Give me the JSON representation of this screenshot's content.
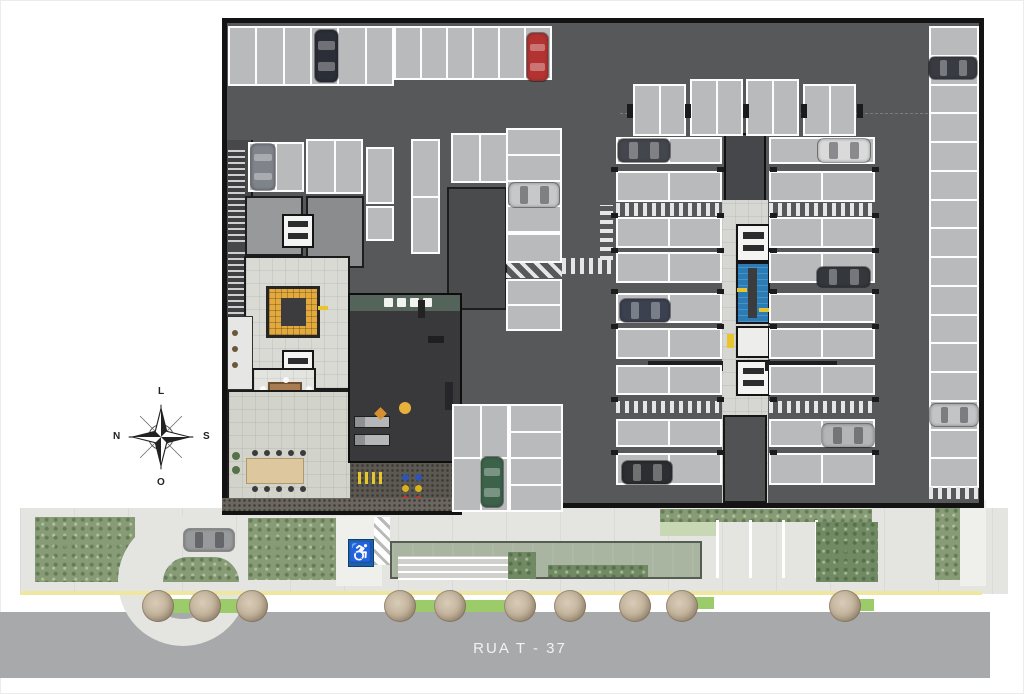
{
  "street": {
    "name": "RUA T - 37"
  },
  "compass": {
    "top": "L",
    "right": "S",
    "bottom": "O",
    "left": "N"
  },
  "symbols": {
    "accessibility": "♿"
  },
  "colors": {
    "garage_floor": "#57585a",
    "garage_border": "#131313",
    "parking_space": "#b9babc",
    "parking_outline": "#fdfdfd",
    "gym_floor": "#39393b",
    "lobby_floor": "#d9dad4",
    "feature_stair_yellow": "#e3a93c",
    "stairwell_blue": "#2b7cb4",
    "accessibility_blue": "#1e5fa9",
    "sidewalk": "#e4e5e1",
    "road": "#a8a9ab",
    "curb_line_yellow": "#efe6a0",
    "hedge_green": "#879c76",
    "grass_green": "#9ccb6a",
    "canopy_green": "#a9b4a1",
    "tree_canopy": "#bcab93",
    "wood_table": "#a87c52",
    "terrace_table": "#dcc79e"
  },
  "parking_groups": [
    {
      "x": 228,
      "y": 26,
      "w": 166,
      "h": 60,
      "cols": 6,
      "rows": 1
    },
    {
      "x": 394,
      "y": 26,
      "w": 158,
      "h": 54,
      "cols": 6,
      "rows": 1
    },
    {
      "x": 248,
      "y": 142,
      "w": 56,
      "h": 50,
      "cols": 2,
      "rows": 1
    },
    {
      "x": 306,
      "y": 139,
      "w": 57,
      "h": 55,
      "cols": 2,
      "rows": 1
    },
    {
      "x": 366,
      "y": 147,
      "w": 28,
      "h": 57,
      "cols": 1,
      "rows": 1
    },
    {
      "x": 411,
      "y": 139,
      "w": 29,
      "h": 63,
      "cols": 1,
      "rows": 1
    },
    {
      "x": 366,
      "y": 206,
      "w": 28,
      "h": 35,
      "cols": 1,
      "rows": 1
    },
    {
      "x": 411,
      "y": 196,
      "w": 29,
      "h": 58,
      "cols": 1,
      "rows": 1
    },
    {
      "x": 451,
      "y": 133,
      "w": 57,
      "h": 50,
      "cols": 2,
      "rows": 1
    },
    {
      "x": 452,
      "y": 404,
      "w": 57,
      "h": 108,
      "cols": 2,
      "rows": 2
    },
    {
      "x": 509,
      "y": 404,
      "w": 54,
      "h": 108,
      "cols": 1,
      "rows": 4
    },
    {
      "x": 506,
      "y": 128,
      "w": 56,
      "h": 105,
      "cols": 1,
      "rows": 4
    },
    {
      "x": 506,
      "y": 279,
      "w": 56,
      "h": 52,
      "cols": 1,
      "rows": 2
    },
    {
      "x": 633,
      "y": 84,
      "w": 53,
      "h": 52,
      "cols": 2,
      "rows": 1
    },
    {
      "x": 690,
      "y": 79,
      "w": 53,
      "h": 57,
      "cols": 2,
      "rows": 1
    },
    {
      "x": 746,
      "y": 79,
      "w": 53,
      "h": 57,
      "cols": 2,
      "rows": 1
    },
    {
      "x": 803,
      "y": 84,
      "w": 53,
      "h": 52,
      "cols": 2,
      "rows": 1
    },
    {
      "x": 616,
      "y": 137,
      "w": 106,
      "h": 27,
      "cols": 2,
      "rows": 1
    },
    {
      "x": 616,
      "y": 171,
      "w": 106,
      "h": 31,
      "cols": 2,
      "rows": 1
    },
    {
      "x": 616,
      "y": 217,
      "w": 106,
      "h": 31,
      "cols": 2,
      "rows": 1
    },
    {
      "x": 616,
      "y": 252,
      "w": 106,
      "h": 31,
      "cols": 2,
      "rows": 1
    },
    {
      "x": 616,
      "y": 293,
      "w": 106,
      "h": 30,
      "cols": 2,
      "rows": 1
    },
    {
      "x": 616,
      "y": 328,
      "w": 106,
      "h": 31,
      "cols": 2,
      "rows": 1
    },
    {
      "x": 616,
      "y": 365,
      "w": 106,
      "h": 30,
      "cols": 2,
      "rows": 1
    },
    {
      "x": 616,
      "y": 419,
      "w": 106,
      "h": 28,
      "cols": 2,
      "rows": 1
    },
    {
      "x": 616,
      "y": 453,
      "w": 106,
      "h": 32,
      "cols": 2,
      "rows": 1
    },
    {
      "x": 769,
      "y": 137,
      "w": 106,
      "h": 27,
      "cols": 2,
      "rows": 1
    },
    {
      "x": 769,
      "y": 171,
      "w": 106,
      "h": 31,
      "cols": 2,
      "rows": 1
    },
    {
      "x": 769,
      "y": 217,
      "w": 106,
      "h": 31,
      "cols": 2,
      "rows": 1
    },
    {
      "x": 769,
      "y": 252,
      "w": 106,
      "h": 31,
      "cols": 2,
      "rows": 1
    },
    {
      "x": 769,
      "y": 293,
      "w": 106,
      "h": 30,
      "cols": 2,
      "rows": 1
    },
    {
      "x": 769,
      "y": 328,
      "w": 106,
      "h": 31,
      "cols": 2,
      "rows": 1
    },
    {
      "x": 769,
      "y": 365,
      "w": 106,
      "h": 30,
      "cols": 2,
      "rows": 1
    },
    {
      "x": 769,
      "y": 419,
      "w": 106,
      "h": 28,
      "cols": 2,
      "rows": 1
    },
    {
      "x": 769,
      "y": 453,
      "w": 106,
      "h": 32,
      "cols": 2,
      "rows": 1
    },
    {
      "x": 929,
      "y": 26,
      "w": 50,
      "h": 462,
      "cols": 1,
      "rows": 16
    }
  ],
  "accessible_space": {
    "x": 506,
    "y": 233,
    "w": 56,
    "h": 30
  },
  "zebras": [
    {
      "x": 562,
      "y": 258,
      "w": 50,
      "h": 16,
      "t": "v"
    },
    {
      "x": 600,
      "y": 205,
      "w": 13,
      "h": 55,
      "t": "h"
    },
    {
      "x": 616,
      "y": 203,
      "w": 106,
      "h": 13,
      "t": "v"
    },
    {
      "x": 769,
      "y": 203,
      "w": 106,
      "h": 13,
      "t": "v"
    },
    {
      "x": 616,
      "y": 401,
      "w": 106,
      "h": 12,
      "t": "v"
    },
    {
      "x": 769,
      "y": 401,
      "w": 106,
      "h": 12,
      "t": "v"
    },
    {
      "x": 929,
      "y": 487,
      "w": 50,
      "h": 12,
      "t": "v"
    },
    {
      "x": 506,
      "y": 263,
      "w": 56,
      "h": 15,
      "t": "d"
    },
    {
      "x": 374,
      "y": 517,
      "w": 16,
      "h": 48,
      "t": "ds"
    }
  ],
  "wall_ticks": {
    "xs": [
      611,
      717,
      770,
      872
    ],
    "ys": [
      167,
      213,
      248,
      289,
      324,
      397,
      450
    ],
    "w": 7,
    "h": 5
  },
  "pair_ticks": {
    "y": 104,
    "xs": [
      627,
      685,
      743,
      801,
      857
    ],
    "w": 6,
    "h": 14
  },
  "cars": [
    {
      "x": 315,
      "y": 30,
      "w": 23,
      "h": 52,
      "dir": "v",
      "c": "#2b2e36"
    },
    {
      "x": 527,
      "y": 33,
      "w": 21,
      "h": 48,
      "dir": "v",
      "c": "#b23331"
    },
    {
      "x": 251,
      "y": 144,
      "w": 24,
      "h": 46,
      "dir": "v",
      "c": "#7f838a"
    },
    {
      "x": 509,
      "y": 183,
      "w": 50,
      "h": 24,
      "dir": "h",
      "c": "#c6c8ca"
    },
    {
      "x": 618,
      "y": 139,
      "w": 52,
      "h": 23,
      "dir": "h",
      "c": "#43464c"
    },
    {
      "x": 818,
      "y": 139,
      "w": 52,
      "h": 23,
      "dir": "h",
      "c": "#dadada"
    },
    {
      "x": 929,
      "y": 57,
      "w": 48,
      "h": 22,
      "dir": "h",
      "c": "#383b42"
    },
    {
      "x": 620,
      "y": 299,
      "w": 50,
      "h": 23,
      "dir": "h",
      "c": "#3c4150"
    },
    {
      "x": 817,
      "y": 267,
      "w": 53,
      "h": 20,
      "dir": "h",
      "c": "#34373c"
    },
    {
      "x": 822,
      "y": 424,
      "w": 52,
      "h": 23,
      "dir": "h",
      "c": "#b3b5b7"
    },
    {
      "x": 622,
      "y": 461,
      "w": 50,
      "h": 23,
      "dir": "h",
      "c": "#2c2e32"
    },
    {
      "x": 930,
      "y": 404,
      "w": 48,
      "h": 22,
      "dir": "h",
      "c": "#c2c4c6"
    },
    {
      "x": 481,
      "y": 457,
      "w": 22,
      "h": 50,
      "dir": "v",
      "c": "#3c624a"
    },
    {
      "x": 184,
      "y": 529,
      "w": 50,
      "h": 22,
      "dir": "h",
      "c": "#97999b"
    }
  ],
  "trees": {
    "y": 606,
    "r": 16,
    "x": [
      158,
      205,
      252,
      400,
      450,
      520,
      570,
      635,
      682,
      845
    ]
  }
}
